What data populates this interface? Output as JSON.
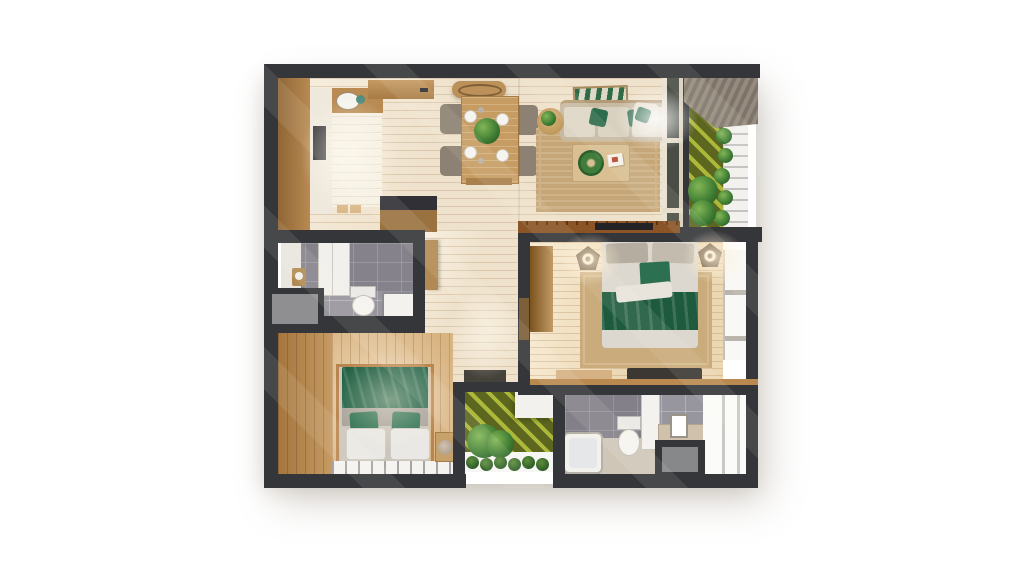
{
  "scene": {
    "type": "3d-floor-plan-top-view-render",
    "background_color": "#ffffff",
    "wall_color": "#35363a"
  },
  "palette": {
    "floor_wood_light": "#efe2cc",
    "floor_wood_warm": "#ecd7b3",
    "floor_wood_bedroom2": "#d9b483",
    "cabinet_wood": "#b98a52",
    "counter_white": "#efe9dd",
    "island_top_dark": "#303036",
    "rug_tan": "#c5a678",
    "sofa_beige": "#d6cdbb",
    "textile_green_dark": "#1d5a3e",
    "textile_green_accent": "#2d7051",
    "tile_gray": "#97959d",
    "grass_olive": "#5c661f",
    "grass_stripe": "#bac63e",
    "fixture_white": "#f3f1ec",
    "shaft_gray": "#8f8f91",
    "tv_console_wood": "#8a5426",
    "roof_slats": "#8d8176"
  },
  "rooms": [
    {
      "id": "kitchen",
      "label": "Kitchen"
    },
    {
      "id": "dining",
      "label": "Dining area"
    },
    {
      "id": "living",
      "label": "Living room"
    },
    {
      "id": "balcony",
      "label": "Balcony garden"
    },
    {
      "id": "hallway",
      "label": "Hallway / entry"
    },
    {
      "id": "bathroom1",
      "label": "Bathroom 1"
    },
    {
      "id": "bedroom_master",
      "label": "Master bedroom"
    },
    {
      "id": "bedroom2",
      "label": "Bedroom 2"
    },
    {
      "id": "patio",
      "label": "Patio garden"
    },
    {
      "id": "bathroom2",
      "label": "Bathroom 2"
    }
  ],
  "furniture": {
    "kitchen": [
      "left-cabinet-run",
      "white-counter",
      "sink",
      "kettle",
      "cooktop",
      "upper-cabinet",
      "island-dark-top",
      "cutting-boards"
    ],
    "dining": [
      "pendant-panel",
      "table",
      "bench",
      "chairs-x4",
      "plates-x4",
      "center-plant"
    ],
    "living": [
      "sofa",
      "green-pillows",
      "wall-art",
      "round-side-table",
      "coffee-table",
      "wreath-plant",
      "book",
      "rug",
      "corner-chair"
    ],
    "bedroom_master": [
      "double-bed",
      "green-blanket",
      "pentagon-lamps-x2",
      "rug",
      "wardrobe",
      "bench",
      "tv-console",
      "windows"
    ],
    "bedroom2": [
      "canopy-bed",
      "green-blanket",
      "pillows",
      "nightstand",
      "teddy-bear",
      "window-strip"
    ],
    "bathroom1": [
      "tall-cabinet",
      "toilet",
      "shower-tray",
      "shaft-box"
    ],
    "bathroom2": [
      "bathtub",
      "toilet",
      "tall-cabinet",
      "vanity",
      "mirror",
      "shaft-box"
    ],
    "balcony": [
      "striped-grass",
      "planter-shrubs",
      "white-railing",
      "slatted-roof"
    ],
    "patio": [
      "striped-grass",
      "white-planter",
      "ferns",
      "shrub-row"
    ]
  }
}
